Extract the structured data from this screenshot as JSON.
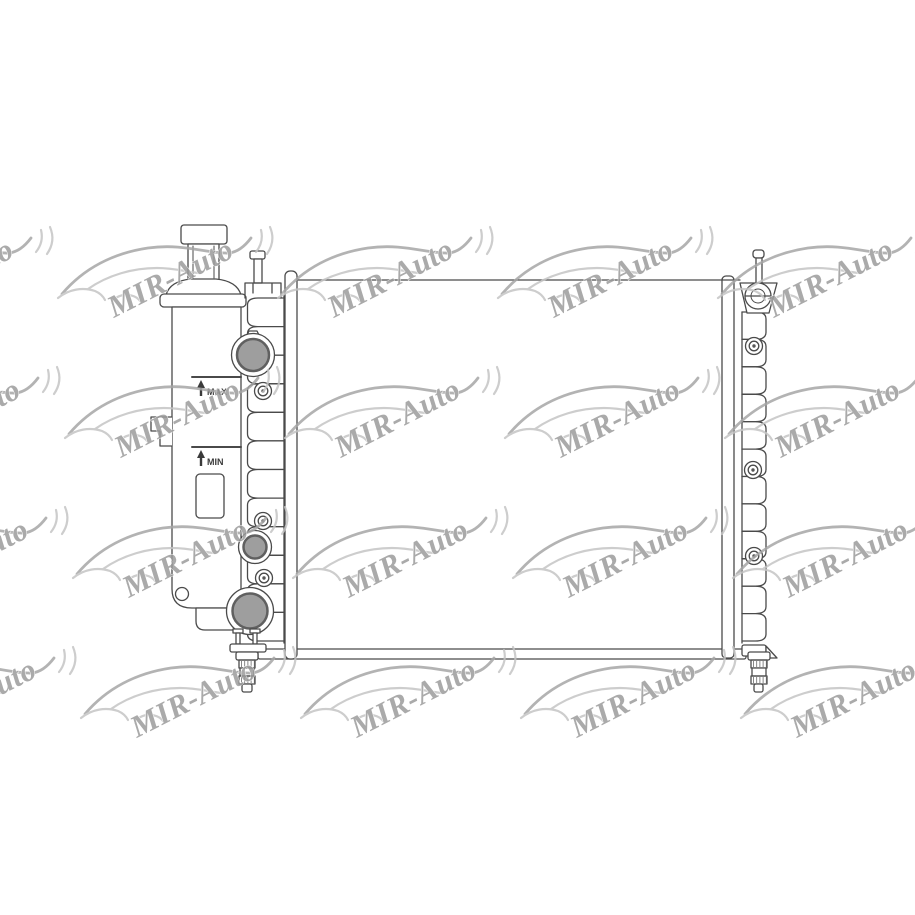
{
  "product_drawing": {
    "subject": "Automotive cooling radiator with integrated expansion tank - technical line drawing",
    "labels": {
      "max_level": "MAX",
      "min_level": "MIN"
    },
    "colors": {
      "background": "#ffffff",
      "line": "#4a4a4a",
      "port_fill": "#9e9e9e",
      "port_ring": "#606060",
      "cap_fill": "#3a3a3a",
      "plug_band": "#8f8f8f"
    }
  },
  "watermark": {
    "label": "MIR-Auto",
    "text_color": "#9b9b9b",
    "car_line_color": "#c4c4c4",
    "car_accent_color": "#a6a6a6",
    "grid": {
      "rows": 4,
      "cols": 5
    }
  }
}
